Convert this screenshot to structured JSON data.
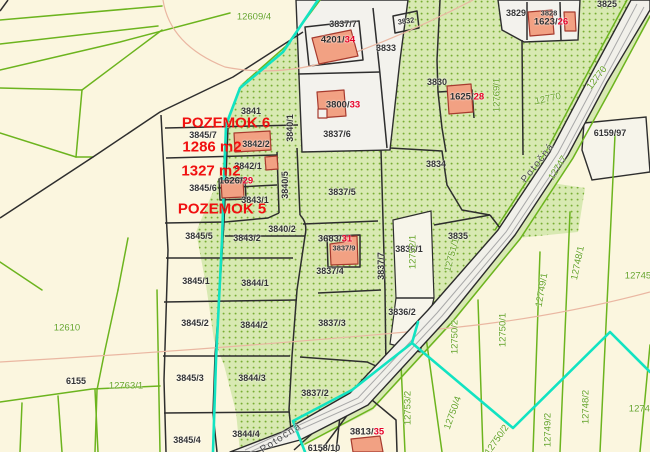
{
  "map": {
    "title": "Cadastral map view",
    "annotations": {
      "pozemok6": "POZEMOK 6",
      "pozemok6_area": "1286 m2",
      "pozemok5_area": "1327 m2",
      "pozemok5": "POZEMOK 5"
    },
    "street_name": "Potočná",
    "palette": {
      "background_cream": "#fbf6df",
      "vegetation_green": "#d8e9b2",
      "vegetation_dot": "#78ad33",
      "white_parcel": "#f3f2ed",
      "road_fill": "#f1f0ea",
      "boundary_black": "#2e2e2e",
      "boundary_green": "#6cb41e",
      "utility_cyan": "#12e3c2",
      "contour_pink": "#eab7a2",
      "building_fill": "#f2a183",
      "building_stroke": "#a63a2e",
      "building_number_red": "#e60028",
      "annotation_red": "#f01010",
      "label_green_text": "#67a327"
    },
    "labels": [
      {
        "text": "12609/4",
        "x": 254,
        "y": 17,
        "cls": "green"
      },
      {
        "text": "3837/7",
        "x": 343,
        "y": 24,
        "cls": "parcel"
      },
      {
        "text": "4201/",
        "red": "34",
        "x": 338,
        "y": 40,
        "cls": "building"
      },
      {
        "text": "3832",
        "x": 406,
        "y": 21,
        "rot": -8,
        "cls": "small"
      },
      {
        "text": "3833",
        "x": 386,
        "y": 48,
        "cls": "parcel"
      },
      {
        "text": "3829",
        "x": 516,
        "y": 13,
        "cls": "parcel"
      },
      {
        "text": "3828",
        "x": 549,
        "y": 13,
        "cls": "small"
      },
      {
        "text": "3825",
        "x": 607,
        "y": 4,
        "cls": "parcel"
      },
      {
        "text": "1623/",
        "red": "26",
        "x": 551,
        "y": 22,
        "cls": "building"
      },
      {
        "text": "3830",
        "x": 437,
        "y": 82,
        "cls": "parcel"
      },
      {
        "text": "1625/",
        "red": "28",
        "x": 467,
        "y": 97,
        "cls": "building"
      },
      {
        "text": "3800/",
        "red": "33",
        "x": 343,
        "y": 105,
        "cls": "building"
      },
      {
        "text": "3837/6",
        "x": 337,
        "y": 134,
        "cls": "parcel"
      },
      {
        "text": "3841",
        "x": 251,
        "y": 111,
        "cls": "parcel"
      },
      {
        "text": "12770",
        "x": 548,
        "y": 99,
        "rot": -12,
        "cls": "green"
      },
      {
        "text": "12770",
        "x": 597,
        "y": 78,
        "rot": -52,
        "cls": "green"
      },
      {
        "text": "12769/1",
        "x": 497,
        "y": 95,
        "rot": -90,
        "cls": "green"
      },
      {
        "text": "Potočná",
        "x": 538,
        "y": 163,
        "rot": -52,
        "cls": "street"
      },
      {
        "text": "12747",
        "x": 558,
        "y": 168,
        "rot": -58,
        "cls": "green"
      },
      {
        "text": "6159/97",
        "x": 610,
        "y": 133,
        "cls": "parcel"
      },
      {
        "text": "POZEMOK 6",
        "x": 226,
        "y": 123,
        "cls": "overlay"
      },
      {
        "text": "3845/7",
        "x": 203,
        "y": 135,
        "cls": "parcel"
      },
      {
        "text": "1286 m2",
        "x": 212,
        "y": 147,
        "cls": "overlay"
      },
      {
        "text": "3842/2",
        "x": 256,
        "y": 144,
        "cls": "parcel"
      },
      {
        "text": "3842/1",
        "x": 248,
        "y": 166,
        "cls": "parcel"
      },
      {
        "text": "1327 m2",
        "x": 211,
        "y": 171,
        "cls": "overlay"
      },
      {
        "text": "1626/",
        "red": "29",
        "x": 236,
        "y": 181,
        "cls": "building"
      },
      {
        "text": "3845/6",
        "x": 203,
        "y": 188,
        "cls": "parcel"
      },
      {
        "text": "3843/1",
        "x": 255,
        "y": 200,
        "cls": "parcel"
      },
      {
        "text": "POZEMOK 5",
        "x": 222,
        "y": 209,
        "cls": "overlay"
      },
      {
        "text": "3840/1",
        "x": 290,
        "y": 128,
        "rot": -90,
        "cls": "parcel"
      },
      {
        "text": "3840/5",
        "x": 285,
        "y": 185,
        "rot": -90,
        "cls": "parcel"
      },
      {
        "text": "3840/2",
        "x": 282,
        "y": 229,
        "cls": "parcel"
      },
      {
        "text": "3845/5",
        "x": 199,
        "y": 236,
        "cls": "parcel"
      },
      {
        "text": "3843/2",
        "x": 247,
        "y": 238,
        "cls": "parcel"
      },
      {
        "text": "3837/5",
        "x": 342,
        "y": 192,
        "cls": "parcel"
      },
      {
        "text": "3834",
        "x": 436,
        "y": 164,
        "cls": "parcel"
      },
      {
        "text": "3837/9",
        "x": 344,
        "y": 248,
        "cls": "small"
      },
      {
        "text": "3683/",
        "red": "31",
        "x": 335,
        "y": 239,
        "cls": "building"
      },
      {
        "text": "3837/4",
        "x": 330,
        "y": 271,
        "cls": "parcel"
      },
      {
        "text": "3837/7",
        "x": 381,
        "y": 266,
        "rot": -90,
        "cls": "parcel"
      },
      {
        "text": "3836/1",
        "x": 409,
        "y": 249,
        "cls": "parcel"
      },
      {
        "text": "12752/1",
        "x": 413,
        "y": 252,
        "rot": -90,
        "cls": "green"
      },
      {
        "text": "3835",
        "x": 458,
        "y": 236,
        "cls": "parcel"
      },
      {
        "text": "12751/1",
        "x": 452,
        "y": 255,
        "rot": -75,
        "cls": "green"
      },
      {
        "text": "12748/1",
        "x": 578,
        "y": 263,
        "rot": -78,
        "cls": "green"
      },
      {
        "text": "12749/1",
        "x": 542,
        "y": 290,
        "rot": -80,
        "cls": "green"
      },
      {
        "text": "12745",
        "x": 638,
        "y": 276,
        "cls": "green"
      },
      {
        "text": "12750/1",
        "x": 503,
        "y": 330,
        "rot": -90,
        "cls": "green"
      },
      {
        "text": "12750/2",
        "x": 455,
        "y": 337,
        "rot": -90,
        "cls": "green"
      },
      {
        "text": "3836/2",
        "x": 402,
        "y": 312,
        "cls": "parcel"
      },
      {
        "text": "3837/3",
        "x": 332,
        "y": 323,
        "cls": "parcel"
      },
      {
        "text": "12610",
        "x": 67,
        "y": 328,
        "cls": "green"
      },
      {
        "text": "6155",
        "x": 76,
        "y": 381,
        "cls": "parcel"
      },
      {
        "text": "12763/1",
        "x": 126,
        "y": 386,
        "cls": "green"
      },
      {
        "text": "3845/1",
        "x": 196,
        "y": 281,
        "cls": "parcel"
      },
      {
        "text": "3844/1",
        "x": 255,
        "y": 283,
        "cls": "parcel"
      },
      {
        "text": "3845/2",
        "x": 195,
        "y": 323,
        "cls": "parcel"
      },
      {
        "text": "3844/2",
        "x": 254,
        "y": 325,
        "cls": "parcel"
      },
      {
        "text": "3845/3",
        "x": 190,
        "y": 378,
        "cls": "parcel"
      },
      {
        "text": "3844/3",
        "x": 252,
        "y": 378,
        "cls": "parcel"
      },
      {
        "text": "3837/2",
        "x": 315,
        "y": 393,
        "cls": "parcel"
      },
      {
        "text": "12753/2",
        "x": 408,
        "y": 408,
        "rot": -90,
        "cls": "green"
      },
      {
        "text": "12750/4",
        "x": 453,
        "y": 413,
        "rot": -70,
        "cls": "green"
      },
      {
        "text": "12750/2",
        "x": 497,
        "y": 440,
        "rot": -55,
        "cls": "green"
      },
      {
        "text": "12749/2",
        "x": 548,
        "y": 430,
        "rot": -90,
        "cls": "green"
      },
      {
        "text": "12748/2",
        "x": 586,
        "y": 407,
        "rot": -90,
        "cls": "green"
      },
      {
        "text": "12745",
        "x": 642,
        "y": 409,
        "cls": "green"
      },
      {
        "text": "3845/4",
        "x": 187,
        "y": 440,
        "cls": "parcel"
      },
      {
        "text": "3844/4",
        "x": 246,
        "y": 434,
        "cls": "parcel"
      },
      {
        "text": "Potočná",
        "x": 281,
        "y": 438,
        "rot": -33,
        "cls": "street"
      },
      {
        "text": "3813/",
        "red": "35",
        "x": 367,
        "y": 432,
        "cls": "building"
      },
      {
        "text": "6158/10",
        "x": 324,
        "y": 448,
        "cls": "parcel"
      }
    ]
  }
}
